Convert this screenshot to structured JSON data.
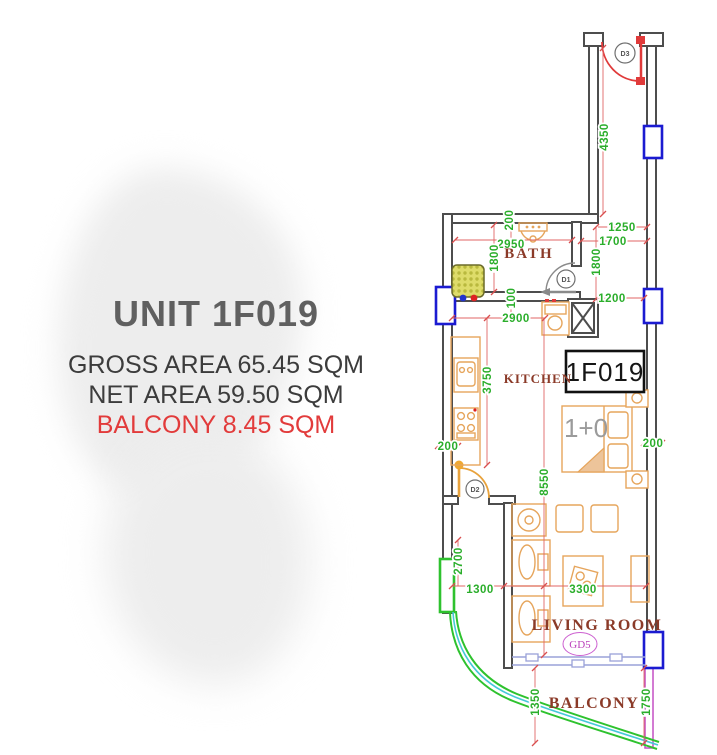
{
  "panel": {
    "title": "UNIT 1F019",
    "lines": {
      "gross": "GROSS AREA 65.45 SQM",
      "net": "NET AREA 59.50 SQM",
      "balcony": "BALCONY 8.45 SQM"
    }
  },
  "plan": {
    "unit_number": "1F019",
    "rooms": {
      "bath": "BATH",
      "kitchen": "KITCHEN",
      "living_room": "LIVING ROOM",
      "balcony": "BALCONY"
    },
    "labels": {
      "bed_type": "1+0",
      "door1": "D1",
      "door2": "D2",
      "door3": "D3",
      "glass_door": "GD5"
    },
    "dims": {
      "corridor": "4350",
      "bath_top_offset": "200",
      "bath_width": "2950",
      "bath_height_left": "1800",
      "bath_height_right": "1800",
      "entry_a": "1250",
      "entry_b": "1700",
      "entry_c": "1200",
      "wall_gap": "100",
      "kitchen_width": "2900",
      "kitchen_height": "3750",
      "main_height": "8550",
      "left_offset": "200",
      "right_offset": "200",
      "nook_height": "2700",
      "nook_width": "1300",
      "living_width": "3300",
      "balcony_depth": "1350",
      "balcony_side": "1750"
    },
    "colors": {
      "wall": "#4d4d4d",
      "dim_text": "#2bae2b",
      "dim_line": "#e06565",
      "window_blue": "#1b1bd1",
      "green_door": "#2ec22e",
      "furniture_orange": "#e6a55c",
      "room_label": "#8b3a28",
      "entrance_red": "#e03a3a",
      "balcony_wall_magenta": "#c44fc4",
      "sliding_door_lavender": "#9aa2d8",
      "rail_cyan": "#46c8d8",
      "balcony_text_red": "#e23b3b"
    }
  }
}
